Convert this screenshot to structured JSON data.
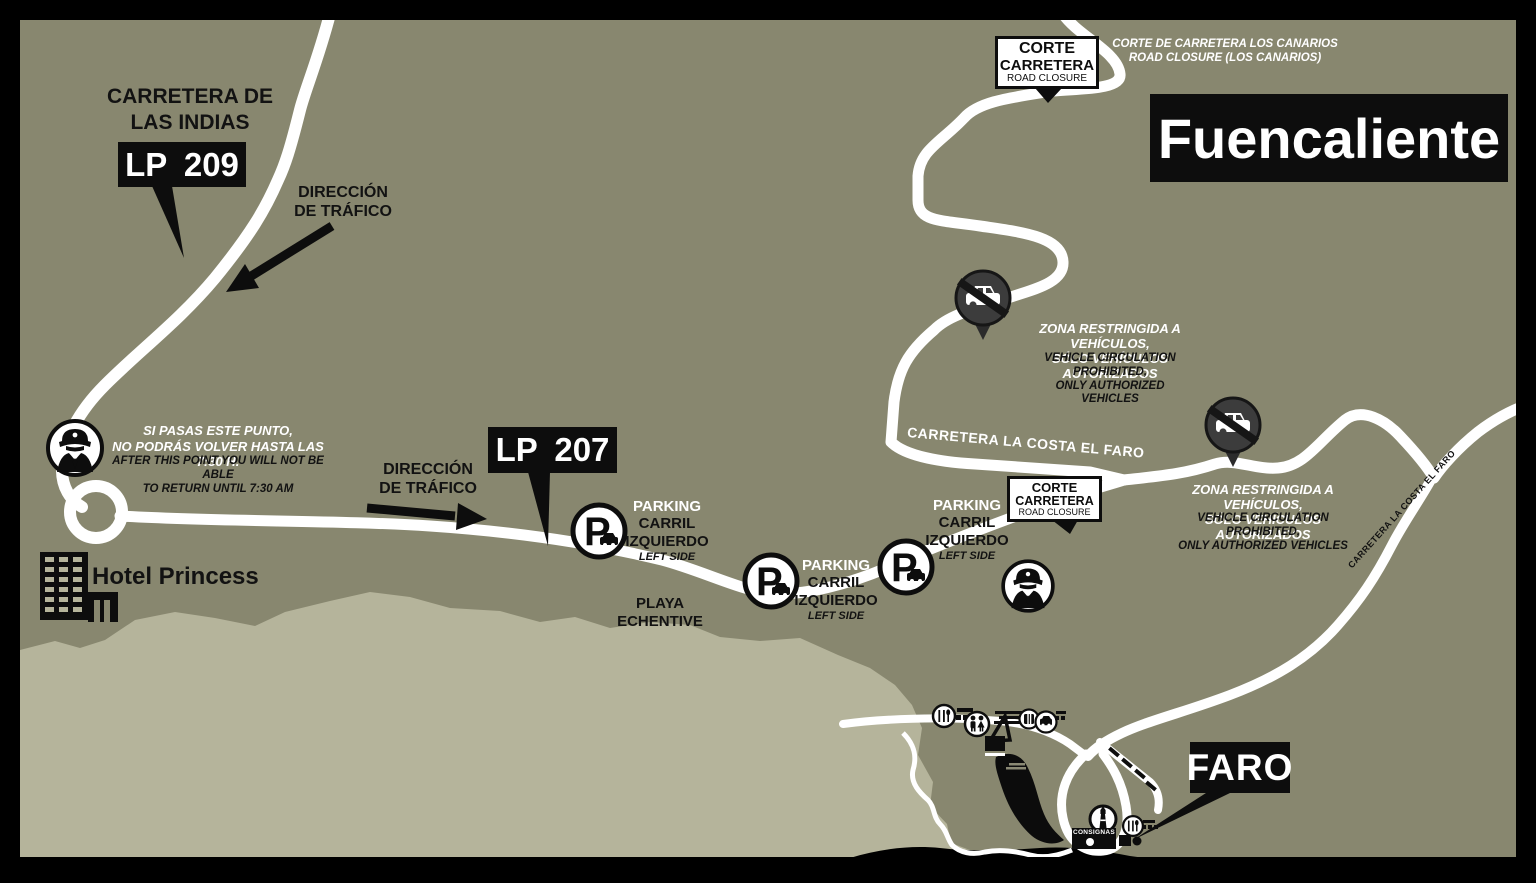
{
  "title": "Fuencaliente",
  "region_labels": {
    "carretera_de_las_indias": "CARRETERA DE\nLAS INDIAS",
    "lp209_badge": "LP 209",
    "lp207_badge": "LP 207",
    "faro_badge": "FARO",
    "playa_echentive": "PLAYA\nECHENTIVE",
    "hotel_princess": "Hotel Princess",
    "carretera_la_costa_el_faro": "CARRETERA LA COSTA EL FARO",
    "consignas": "CONSIGNAS"
  },
  "traffic_direction_label": "DIRECCIÓN\nDE TRÁFICO",
  "road_closure_sign": {
    "line1": "CORTE",
    "line2": "CARRETERA",
    "line3": "ROAD CLOSURE"
  },
  "los_canarios_closure_note": "CORTE DE CARRETERA LOS CANARIOS\nROAD CLOSURE (LOS CANARIOS)",
  "restricted_zone_note": {
    "es": "ZONA RESTRINGIDA A VEHÍCULOS,\nSÓLO VEHÍCULOS AUTORIZADOS",
    "en": "VEHICLE CIRCULATION\nPROHIBITED,\nONLY AUTHORIZED VEHICLES"
  },
  "checkpoint_note": {
    "es": "SI PASAS ESTE PUNTO,\nNO PODRÁS VOLVER HASTA LAS 7:30 H.",
    "en": "AFTER THIS POINT YOU WILL NOT BE ABLE\nTO RETURN UNTIL 7:30 AM"
  },
  "parking_label": {
    "title": "PARKING",
    "lane": "CARRIL\nIZQUIERDO",
    "side": "LEFT SIDE"
  },
  "icons": {
    "no_vehicles": "no-vehicles-icon",
    "police_officer": "police-officer-icon",
    "parking": "parking-icon",
    "restaurant": "restaurant-icon",
    "wc": "wc-icon",
    "services": "services-icon",
    "vehicle_stop": "vehicle-stop-icon",
    "lighthouse": "lighthouse-icon",
    "hotel_building": "hotel-building-icon",
    "boat_ramp": "boat-ramp-icon"
  },
  "colors": {
    "land": "#88876F",
    "beach": "#B5B49B",
    "road": "#FFFFFF",
    "ink": "#121212",
    "frame": "#000000",
    "restricted_icon_bg": "#3C3C3C"
  }
}
